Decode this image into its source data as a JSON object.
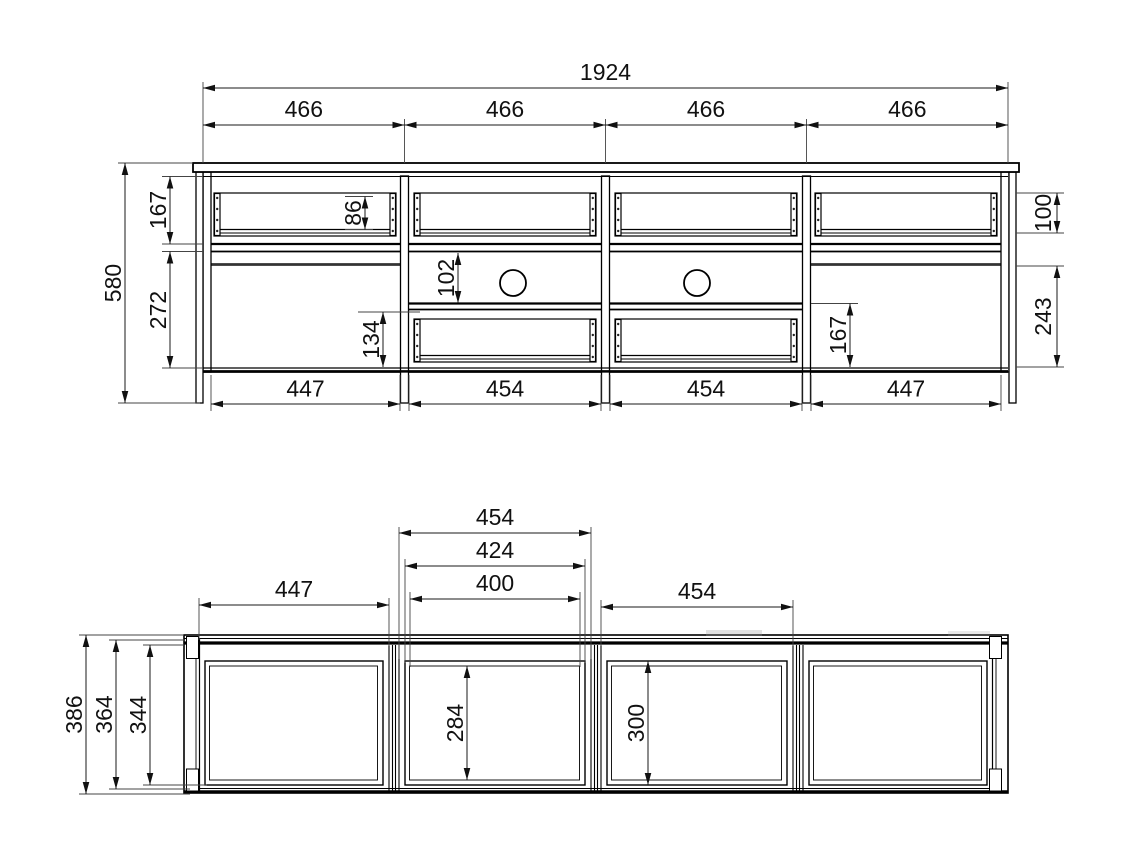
{
  "front_view": {
    "total_width": "1924",
    "section_widths": [
      "466",
      "466",
      "466",
      "466"
    ],
    "overall_height": "580",
    "upper_opening_height": "167",
    "lower_opening_height": "272",
    "drawer_back_height": "86",
    "niche_height": "102",
    "lower_drawer_height": "134",
    "lower_right_opening_height": "167",
    "right_drawer_height": "100",
    "right_opening_height": "243",
    "bottom_widths": [
      "447",
      "454",
      "454",
      "447"
    ]
  },
  "top_view": {
    "left_compartment_width": "447",
    "second_compartment_width": "454",
    "second_door_width": "424",
    "second_clear_width": "400",
    "third_compartment_width": "454",
    "overall_depth": "386",
    "inner_depth": "364",
    "door_depth": "344",
    "second_clear_depth": "284",
    "third_clear_depth": "300"
  },
  "colors": {
    "line": "#000000",
    "background": "#ffffff",
    "dimension_text": "#111111"
  }
}
